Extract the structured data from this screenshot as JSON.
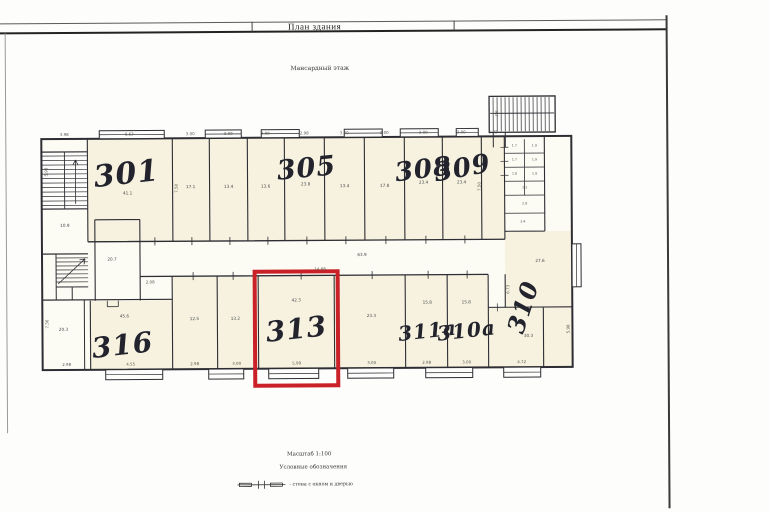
{
  "frame": {
    "title": "План здания"
  },
  "plan": {
    "subtitle": "Мансардный этаж",
    "footer": {
      "scale": "Масштаб 1:100",
      "legend_heading": "Условные обозначения",
      "legend_item_label": "- стена с окном и дверью"
    },
    "highlight": {
      "room": "313",
      "color": "#c92127"
    },
    "room_labels": [
      {
        "t": "301",
        "x": 127,
        "y": 173,
        "s": 30,
        "r": -6
      },
      {
        "t": "305",
        "x": 307,
        "y": 168,
        "s": 27,
        "r": -5
      },
      {
        "t": "308",
        "x": 424,
        "y": 170,
        "s": 26,
        "r": -7
      },
      {
        "t": "309",
        "x": 463,
        "y": 169,
        "s": 26,
        "r": -10
      },
      {
        "t": "316",
        "x": 122,
        "y": 344,
        "s": 28,
        "r": -6
      },
      {
        "t": "313",
        "x": 296,
        "y": 329,
        "s": 28,
        "r": -6
      },
      {
        "t": "311а",
        "x": 427,
        "y": 331,
        "s": 20,
        "r": -6
      },
      {
        "t": "310а",
        "x": 466,
        "y": 331,
        "s": 20,
        "r": -6
      },
      {
        "t": "310",
        "x": 523,
        "y": 308,
        "s": 24,
        "r": -72
      }
    ],
    "annotations": [
      {
        "t": "3.98",
        "x": 65,
        "y": 133,
        "cls": "dim"
      },
      {
        "t": "6.63",
        "x": 130,
        "y": 133,
        "cls": "dim"
      },
      {
        "t": "3.00",
        "x": 191,
        "y": 133,
        "cls": "dim"
      },
      {
        "t": "3.00",
        "x": 229,
        "y": 133,
        "cls": "dim"
      },
      {
        "t": "3.00",
        "x": 266,
        "y": 133,
        "cls": "dim"
      },
      {
        "t": "2.98",
        "x": 305,
        "y": 133,
        "cls": "dim"
      },
      {
        "t": "3.00",
        "x": 345,
        "y": 133,
        "cls": "dim"
      },
      {
        "t": "3.00",
        "x": 385,
        "y": 133,
        "cls": "dim"
      },
      {
        "t": "3.00",
        "x": 424,
        "y": 133,
        "cls": "dim"
      },
      {
        "t": "3.00",
        "x": 462,
        "y": 133,
        "cls": "dim"
      },
      {
        "t": "5.03",
        "x": 494,
        "y": 133,
        "cls": "dim"
      },
      {
        "t": "2.98",
        "x": 66,
        "y": 363,
        "cls": "dim"
      },
      {
        "t": "4.55",
        "x": 130,
        "y": 363,
        "cls": "dim"
      },
      {
        "t": "2.98",
        "x": 194,
        "y": 363,
        "cls": "dim"
      },
      {
        "t": "3.00",
        "x": 236,
        "y": 363,
        "cls": "dim"
      },
      {
        "t": "5.99",
        "x": 296,
        "y": 363,
        "cls": "dim"
      },
      {
        "t": "3.00",
        "x": 371,
        "y": 363,
        "cls": "dim"
      },
      {
        "t": "2.98",
        "x": 426,
        "y": 363,
        "cls": "dim"
      },
      {
        "t": "3.00",
        "x": 466,
        "y": 363,
        "cls": "dim"
      },
      {
        "t": "4.72",
        "x": 521,
        "y": 363,
        "cls": "dim"
      },
      {
        "t": "5.98",
        "x": 47,
        "y": 170,
        "cls": "dimv"
      },
      {
        "t": "7.50",
        "x": 177,
        "y": 187,
        "cls": "dimv"
      },
      {
        "t": "7.50",
        "x": 480,
        "y": 187,
        "cls": "dimv"
      },
      {
        "t": "7.36",
        "x": 47,
        "y": 322,
        "cls": "dimv"
      },
      {
        "t": "6.73",
        "x": 508,
        "y": 290,
        "cls": "dimv"
      },
      {
        "t": "5.98",
        "x": 568,
        "y": 330,
        "cls": "dimv"
      },
      {
        "t": "ЛК",
        "x": 498,
        "y": 114,
        "cls": "dimv"
      },
      {
        "t": "2.08",
        "x": 150,
        "y": 281,
        "cls": "dim"
      },
      {
        "t": "14.68",
        "x": 320,
        "y": 269,
        "cls": "dim"
      },
      {
        "t": "41.1",
        "x": 128,
        "y": 192,
        "cls": "area"
      },
      {
        "t": "17.1",
        "x": 191,
        "y": 186,
        "cls": "area"
      },
      {
        "t": "13.4",
        "x": 229,
        "y": 186,
        "cls": "area"
      },
      {
        "t": "13.6",
        "x": 266,
        "y": 186,
        "cls": "area"
      },
      {
        "t": "23.8",
        "x": 306,
        "y": 184,
        "cls": "area"
      },
      {
        "t": "13.4",
        "x": 345,
        "y": 186,
        "cls": "area"
      },
      {
        "t": "17.8",
        "x": 385,
        "y": 186,
        "cls": "area"
      },
      {
        "t": "23.4",
        "x": 424,
        "y": 183,
        "cls": "area"
      },
      {
        "t": "23.4",
        "x": 462,
        "y": 183,
        "cls": "area"
      },
      {
        "t": "10.9",
        "x": 65,
        "y": 224,
        "cls": "area"
      },
      {
        "t": "20.7",
        "x": 112,
        "y": 258,
        "cls": "area"
      },
      {
        "t": "63.9",
        "x": 362,
        "y": 255,
        "cls": "area"
      },
      {
        "t": "20.3",
        "x": 63,
        "y": 328,
        "cls": "area"
      },
      {
        "t": "45.6",
        "x": 124,
        "y": 315,
        "cls": "area"
      },
      {
        "t": "12.5",
        "x": 194,
        "y": 318,
        "cls": "area"
      },
      {
        "t": "13.2",
        "x": 235,
        "y": 318,
        "cls": "area"
      },
      {
        "t": "42.3",
        "x": 296,
        "y": 300,
        "cls": "area"
      },
      {
        "t": "23.3",
        "x": 371,
        "y": 316,
        "cls": "area"
      },
      {
        "t": "15.8",
        "x": 427,
        "y": 303,
        "cls": "area"
      },
      {
        "t": "15.8",
        "x": 466,
        "y": 303,
        "cls": "area"
      },
      {
        "t": "30.3",
        "x": 528,
        "y": 337,
        "cls": "area"
      },
      {
        "t": "27.6",
        "x": 540,
        "y": 262,
        "cls": "area"
      },
      {
        "t": "1.7",
        "x": 515,
        "y": 147,
        "cls": "tiny"
      },
      {
        "t": "1.9",
        "x": 535,
        "y": 147,
        "cls": "tiny"
      },
      {
        "t": "1.7",
        "x": 515,
        "y": 161,
        "cls": "tiny"
      },
      {
        "t": "1.9",
        "x": 535,
        "y": 161,
        "cls": "tiny"
      },
      {
        "t": "1.8",
        "x": 515,
        "y": 175,
        "cls": "tiny"
      },
      {
        "t": "1.9",
        "x": 535,
        "y": 175,
        "cls": "tiny"
      },
      {
        "t": "3.3",
        "x": 525,
        "y": 189,
        "cls": "tiny"
      },
      {
        "t": "2.8",
        "x": 525,
        "y": 205,
        "cls": "tiny"
      },
      {
        "t": "3.4",
        "x": 523,
        "y": 223,
        "cls": "tiny"
      }
    ]
  }
}
